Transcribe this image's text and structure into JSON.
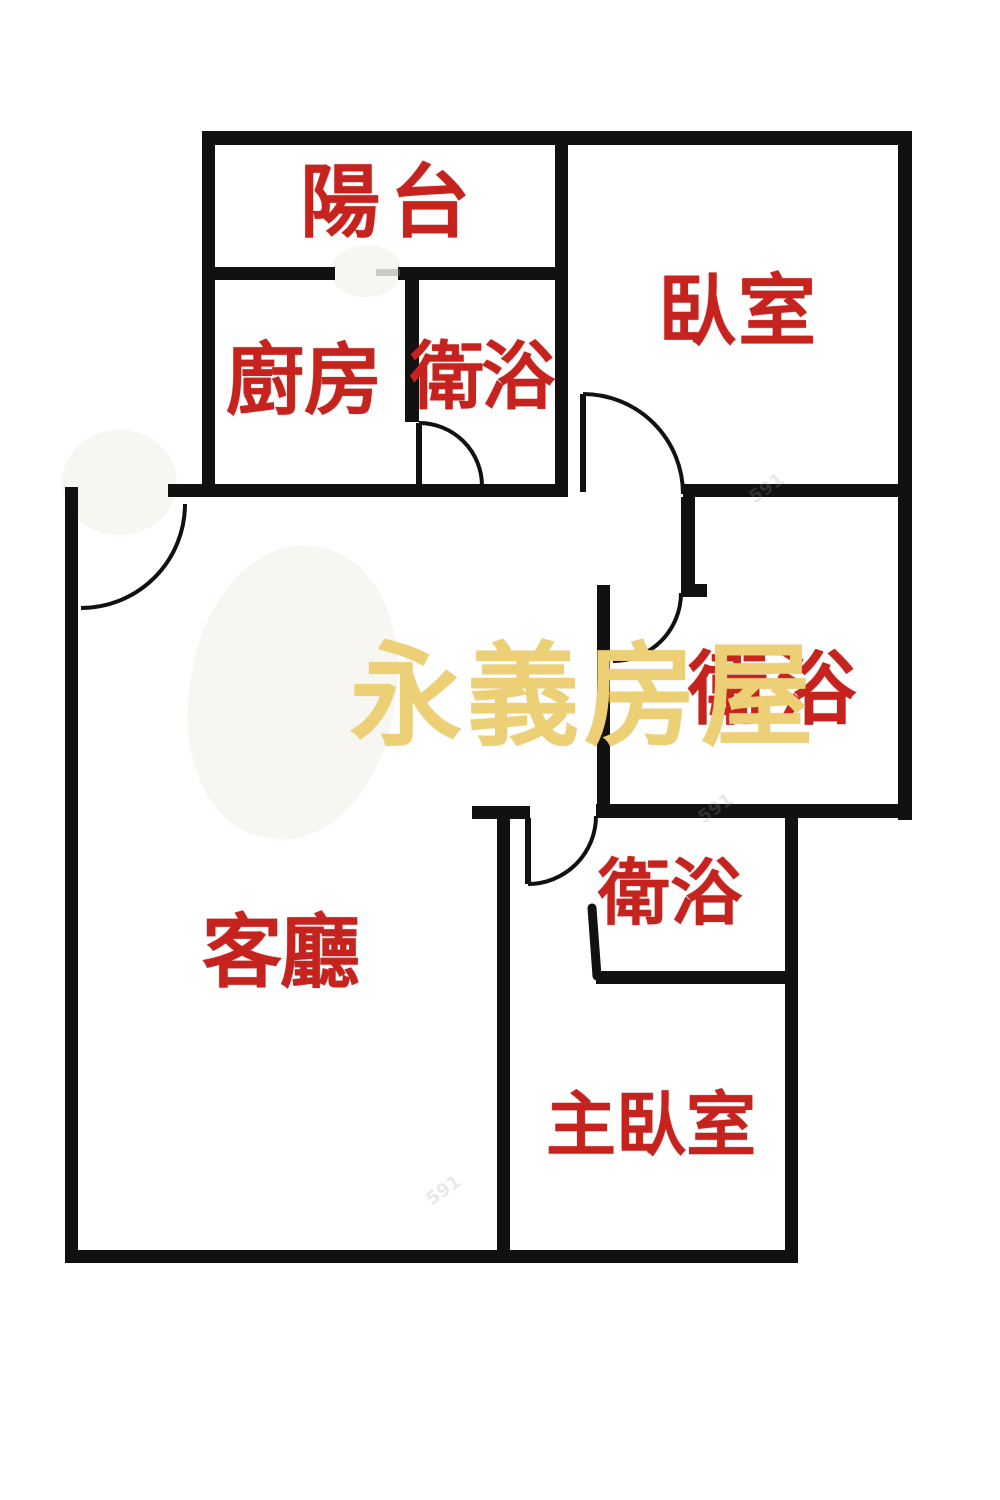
{
  "palette": {
    "wall": "#111111",
    "room_label_red": "#c7231e",
    "brand_yellow": "#edcf75",
    "background": "#ffffff",
    "site_mark_gray": "#9a9a9a"
  },
  "rooms": {
    "balcony": {
      "label": "陽台"
    },
    "kitchen": {
      "label": "廚房"
    },
    "bathroom_top": {
      "label": "衛浴"
    },
    "bedroom": {
      "label": "臥室"
    },
    "bathroom_middle": {
      "label": "衛浴"
    },
    "living_room": {
      "label": "客廳"
    },
    "bathroom_lower": {
      "label": "衛浴"
    },
    "master_bedroom": {
      "label": "主臥室"
    }
  },
  "watermark": {
    "text": "永義房屋"
  },
  "site_watermark": {
    "text": "591"
  }
}
